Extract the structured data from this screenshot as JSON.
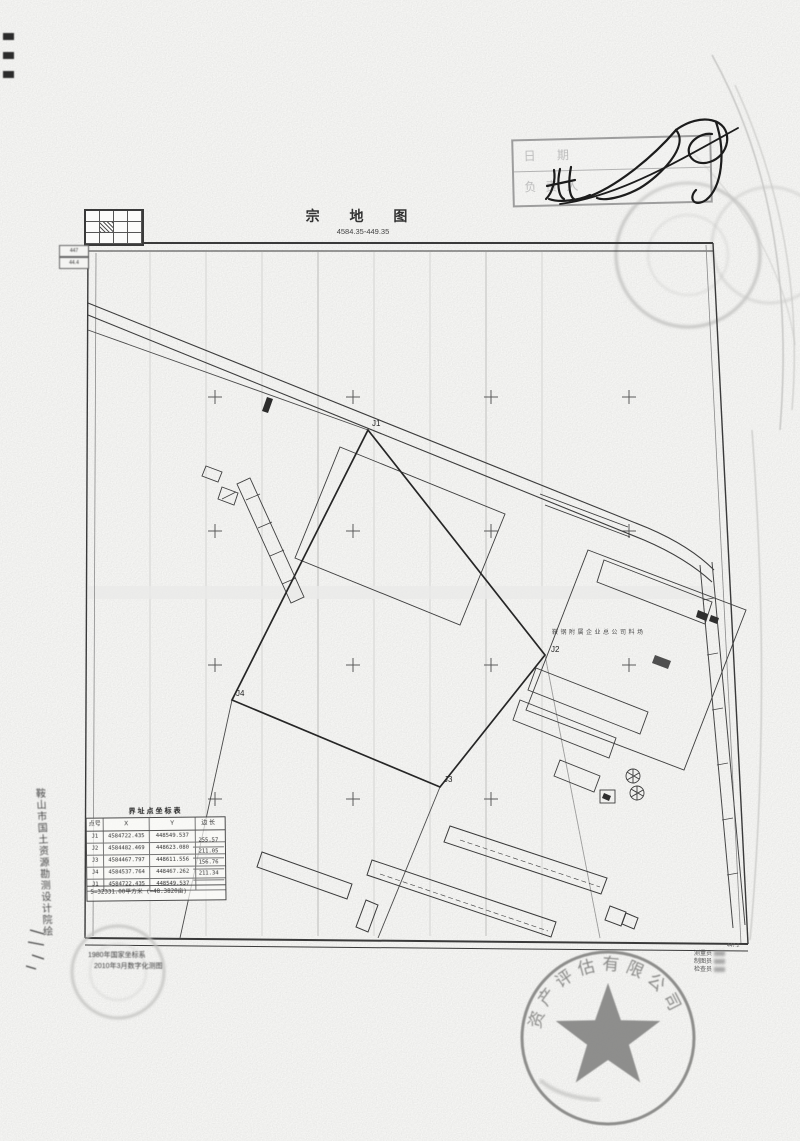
{
  "header": {
    "title": "宗 地 图",
    "subtitle": "4584.35-449.35"
  },
  "scale_cells": [
    "447",
    "44.4"
  ],
  "approval": {
    "row1": "日 期",
    "row2": "负责人"
  },
  "map": {
    "point_labels": [
      "J1",
      "J2",
      "J3",
      "J4"
    ],
    "site_label": "鞍钢附属企业总公司料场",
    "corner_number": "447.2"
  },
  "coord_table": {
    "title": "界址点坐标表",
    "headers": [
      "点号",
      "X",
      "Y",
      "边 长"
    ],
    "rows": [
      [
        "J1",
        "4584722.435",
        "448549.537"
      ],
      [
        "J2",
        "4584482.469",
        "448623.080"
      ],
      [
        "J3",
        "4584467.797",
        "448611.556"
      ],
      [
        "J4",
        "4584537.764",
        "448467.262"
      ],
      [
        "J1",
        "4584722.435",
        "448549.537"
      ]
    ],
    "edges": [
      "255.57",
      "211.05",
      "156.76",
      "211.34"
    ],
    "summary": "S=32331.00平方米 (=48.3820亩)"
  },
  "notes": {
    "left_vertical": "鞍山市国土资源勘测设计院绘",
    "line1": "1980年国家坐标系",
    "line2": "2010年3月数字化测图"
  },
  "staff": [
    "测量员",
    "制图员",
    "检查员"
  ],
  "stamps": {
    "company_ring": "资产评估有限公司"
  },
  "colors": {
    "ink": "#2e2e2e",
    "stamp_gray": "#9a9a9a",
    "paper": "#f7f7f5"
  }
}
